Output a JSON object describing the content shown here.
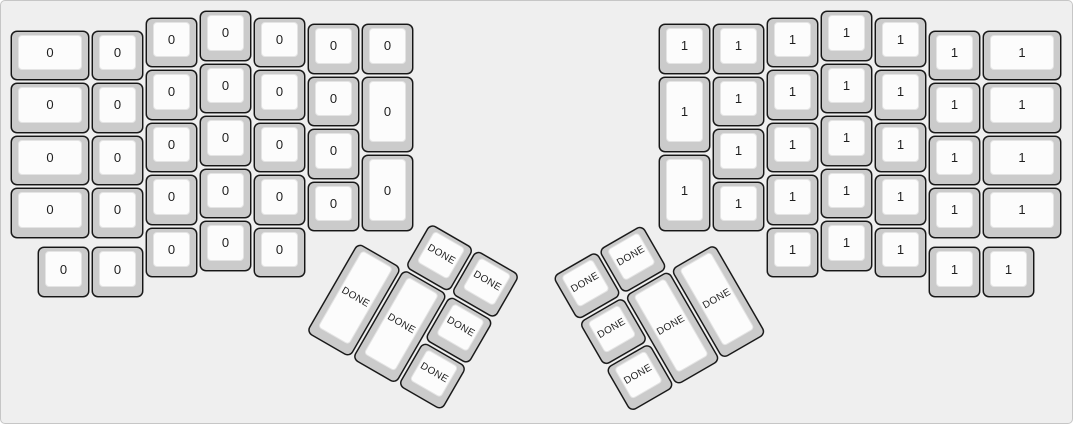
{
  "app": {
    "description": "split ergonomic keyboard layout preview",
    "background_color": "#efefef",
    "canvas_border_color": "#c6c6c6",
    "keycap_base_color": "#cbcbcb",
    "keycap_top_color": "#fcfcfc",
    "keycap_border_color": "#161616",
    "label_color": "#1f1f1f"
  },
  "legends": {
    "left_half": "0",
    "right_half": "1",
    "thumb_keys": "DONE"
  },
  "thumb_clusters": [
    {
      "name": "left-thumb-cluster",
      "origin_x": 357,
      "origin_y": 242,
      "angle_deg": 30
    },
    {
      "name": "right-thumb-cluster",
      "origin_x": 716,
      "origin_y": 242,
      "angle_deg": -30
    }
  ],
  "keys": [
    {
      "group": "left",
      "x": 0,
      "y": 0.375,
      "w": 1.5,
      "h": 1,
      "label": "0"
    },
    {
      "group": "left",
      "x": 0,
      "y": 1.375,
      "w": 1.5,
      "h": 1,
      "label": "0"
    },
    {
      "group": "left",
      "x": 0,
      "y": 2.375,
      "w": 1.5,
      "h": 1,
      "label": "0"
    },
    {
      "group": "left",
      "x": 0,
      "y": 3.375,
      "w": 1.5,
      "h": 1,
      "label": "0"
    },
    {
      "group": "left",
      "x": 1.5,
      "y": 0.375,
      "w": 1,
      "h": 1,
      "label": "0"
    },
    {
      "group": "left",
      "x": 1.5,
      "y": 1.375,
      "w": 1,
      "h": 1,
      "label": "0"
    },
    {
      "group": "left",
      "x": 1.5,
      "y": 2.375,
      "w": 1,
      "h": 1,
      "label": "0"
    },
    {
      "group": "left",
      "x": 1.5,
      "y": 3.375,
      "w": 1,
      "h": 1,
      "label": "0"
    },
    {
      "group": "left",
      "x": 1.5,
      "y": 4.5,
      "w": 1,
      "h": 1,
      "label": "0"
    },
    {
      "group": "left",
      "x": 0.5,
      "y": 4.5,
      "w": 1,
      "h": 1,
      "label": "0"
    },
    {
      "group": "left",
      "x": 2.5,
      "y": 0.125,
      "w": 1,
      "h": 1,
      "label": "0"
    },
    {
      "group": "left",
      "x": 2.5,
      "y": 1.125,
      "w": 1,
      "h": 1,
      "label": "0"
    },
    {
      "group": "left",
      "x": 2.5,
      "y": 2.125,
      "w": 1,
      "h": 1,
      "label": "0"
    },
    {
      "group": "left",
      "x": 2.5,
      "y": 3.125,
      "w": 1,
      "h": 1,
      "label": "0"
    },
    {
      "group": "left",
      "x": 2.5,
      "y": 4.125,
      "w": 1,
      "h": 1,
      "label": "0"
    },
    {
      "group": "left",
      "x": 3.5,
      "y": 0,
      "w": 1,
      "h": 1,
      "label": "0"
    },
    {
      "group": "left",
      "x": 3.5,
      "y": 1,
      "w": 1,
      "h": 1,
      "label": "0"
    },
    {
      "group": "left",
      "x": 3.5,
      "y": 2,
      "w": 1,
      "h": 1,
      "label": "0"
    },
    {
      "group": "left",
      "x": 3.5,
      "y": 3,
      "w": 1,
      "h": 1,
      "label": "0"
    },
    {
      "group": "left",
      "x": 3.5,
      "y": 4,
      "w": 1,
      "h": 1,
      "label": "0"
    },
    {
      "group": "left",
      "x": 4.5,
      "y": 0.125,
      "w": 1,
      "h": 1,
      "label": "0"
    },
    {
      "group": "left",
      "x": 4.5,
      "y": 1.125,
      "w": 1,
      "h": 1,
      "label": "0"
    },
    {
      "group": "left",
      "x": 4.5,
      "y": 2.125,
      "w": 1,
      "h": 1,
      "label": "0"
    },
    {
      "group": "left",
      "x": 4.5,
      "y": 3.125,
      "w": 1,
      "h": 1,
      "label": "0"
    },
    {
      "group": "left",
      "x": 4.5,
      "y": 4.125,
      "w": 1,
      "h": 1,
      "label": "0"
    },
    {
      "group": "left",
      "x": 5.5,
      "y": 0.25,
      "w": 1,
      "h": 1,
      "label": "0"
    },
    {
      "group": "left",
      "x": 5.5,
      "y": 1.25,
      "w": 1,
      "h": 1,
      "label": "0"
    },
    {
      "group": "left",
      "x": 5.5,
      "y": 2.25,
      "w": 1,
      "h": 1,
      "label": "0"
    },
    {
      "group": "left",
      "x": 5.5,
      "y": 3.25,
      "w": 1,
      "h": 1,
      "label": "0"
    },
    {
      "group": "left",
      "x": 6.5,
      "y": 0.25,
      "w": 1,
      "h": 1,
      "label": "0"
    },
    {
      "group": "left",
      "x": 6.5,
      "y": 1.25,
      "w": 1,
      "h": 1.5,
      "label": "0"
    },
    {
      "group": "left",
      "x": 6.5,
      "y": 2.75,
      "w": 1,
      "h": 1.5,
      "label": "0"
    },
    {
      "group": "right",
      "x": 12,
      "y": 0.25,
      "w": 1,
      "h": 1,
      "label": "1"
    },
    {
      "group": "right",
      "x": 12,
      "y": 1.25,
      "w": 1,
      "h": 1.5,
      "label": "1"
    },
    {
      "group": "right",
      "x": 12,
      "y": 2.75,
      "w": 1,
      "h": 1.5,
      "label": "1"
    },
    {
      "group": "right",
      "x": 13,
      "y": 0.25,
      "w": 1,
      "h": 1,
      "label": "1"
    },
    {
      "group": "right",
      "x": 13,
      "y": 1.25,
      "w": 1,
      "h": 1,
      "label": "1"
    },
    {
      "group": "right",
      "x": 13,
      "y": 2.25,
      "w": 1,
      "h": 1,
      "label": "1"
    },
    {
      "group": "right",
      "x": 13,
      "y": 3.25,
      "w": 1,
      "h": 1,
      "label": "1"
    },
    {
      "group": "right",
      "x": 14,
      "y": 0.125,
      "w": 1,
      "h": 1,
      "label": "1"
    },
    {
      "group": "right",
      "x": 14,
      "y": 1.125,
      "w": 1,
      "h": 1,
      "label": "1"
    },
    {
      "group": "right",
      "x": 14,
      "y": 2.125,
      "w": 1,
      "h": 1,
      "label": "1"
    },
    {
      "group": "right",
      "x": 14,
      "y": 3.125,
      "w": 1,
      "h": 1,
      "label": "1"
    },
    {
      "group": "right",
      "x": 14,
      "y": 4.125,
      "w": 1,
      "h": 1,
      "label": "1"
    },
    {
      "group": "right",
      "x": 15,
      "y": 0,
      "w": 1,
      "h": 1,
      "label": "1"
    },
    {
      "group": "right",
      "x": 15,
      "y": 1,
      "w": 1,
      "h": 1,
      "label": "1"
    },
    {
      "group": "right",
      "x": 15,
      "y": 2,
      "w": 1,
      "h": 1,
      "label": "1"
    },
    {
      "group": "right",
      "x": 15,
      "y": 3,
      "w": 1,
      "h": 1,
      "label": "1"
    },
    {
      "group": "right",
      "x": 15,
      "y": 4,
      "w": 1,
      "h": 1,
      "label": "1"
    },
    {
      "group": "right",
      "x": 16,
      "y": 0.125,
      "w": 1,
      "h": 1,
      "label": "1"
    },
    {
      "group": "right",
      "x": 16,
      "y": 1.125,
      "w": 1,
      "h": 1,
      "label": "1"
    },
    {
      "group": "right",
      "x": 16,
      "y": 2.125,
      "w": 1,
      "h": 1,
      "label": "1"
    },
    {
      "group": "right",
      "x": 16,
      "y": 3.125,
      "w": 1,
      "h": 1,
      "label": "1"
    },
    {
      "group": "right",
      "x": 16,
      "y": 4.125,
      "w": 1,
      "h": 1,
      "label": "1"
    },
    {
      "group": "right",
      "x": 17,
      "y": 0.375,
      "w": 1,
      "h": 1,
      "label": "1"
    },
    {
      "group": "right",
      "x": 17,
      "y": 1.375,
      "w": 1,
      "h": 1,
      "label": "1"
    },
    {
      "group": "right",
      "x": 17,
      "y": 2.375,
      "w": 1,
      "h": 1,
      "label": "1"
    },
    {
      "group": "right",
      "x": 17,
      "y": 3.375,
      "w": 1,
      "h": 1,
      "label": "1"
    },
    {
      "group": "right",
      "x": 17,
      "y": 4.5,
      "w": 1,
      "h": 1,
      "label": "1"
    },
    {
      "group": "right",
      "x": 18,
      "y": 0.375,
      "w": 1.5,
      "h": 1,
      "label": "1"
    },
    {
      "group": "right",
      "x": 18,
      "y": 1.375,
      "w": 1.5,
      "h": 1,
      "label": "1"
    },
    {
      "group": "right",
      "x": 18,
      "y": 2.375,
      "w": 1.5,
      "h": 1,
      "label": "1"
    },
    {
      "group": "right",
      "x": 18,
      "y": 3.375,
      "w": 1.5,
      "h": 1,
      "label": "1"
    },
    {
      "group": "right",
      "x": 18,
      "y": 4.5,
      "w": 1,
      "h": 1,
      "label": "1"
    },
    {
      "group": "thumb-left",
      "x": 1,
      "y": -1,
      "w": 1,
      "h": 1,
      "label": "DONE"
    },
    {
      "group": "thumb-left",
      "x": 2,
      "y": -1,
      "w": 1,
      "h": 1,
      "label": "DONE"
    },
    {
      "group": "thumb-left",
      "x": 0,
      "y": 0,
      "w": 1,
      "h": 2,
      "label": "DONE"
    },
    {
      "group": "thumb-left",
      "x": 1,
      "y": 0,
      "w": 1,
      "h": 2,
      "label": "DONE"
    },
    {
      "group": "thumb-left",
      "x": 2,
      "y": 0,
      "w": 1,
      "h": 1,
      "label": "DONE"
    },
    {
      "group": "thumb-left",
      "x": 2,
      "y": 1,
      "w": 1,
      "h": 1,
      "label": "DONE"
    },
    {
      "group": "thumb-right",
      "x": -2,
      "y": -1,
      "w": 1,
      "h": 1,
      "label": "DONE"
    },
    {
      "group": "thumb-right",
      "x": -3,
      "y": -1,
      "w": 1,
      "h": 1,
      "label": "DONE"
    },
    {
      "group": "thumb-right",
      "x": -1,
      "y": 0,
      "w": 1,
      "h": 2,
      "label": "DONE"
    },
    {
      "group": "thumb-right",
      "x": -2,
      "y": 0,
      "w": 1,
      "h": 2,
      "label": "DONE"
    },
    {
      "group": "thumb-right",
      "x": -3,
      "y": 0,
      "w": 1,
      "h": 1,
      "label": "DONE"
    },
    {
      "group": "thumb-right",
      "x": -3,
      "y": 1,
      "w": 1,
      "h": 1,
      "label": "DONE"
    }
  ]
}
